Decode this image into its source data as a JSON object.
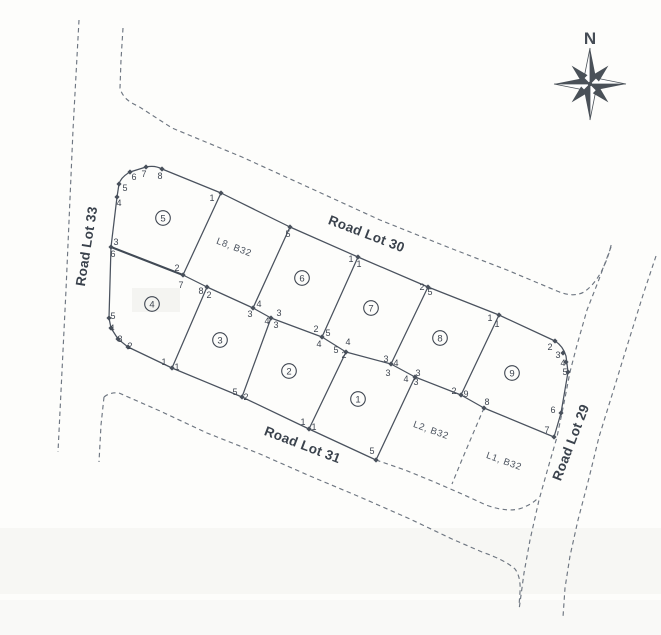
{
  "compass": {
    "label": "N"
  },
  "roads": [
    {
      "name": "Road Lot 30",
      "x": 365,
      "y": 238,
      "rotation": 21
    },
    {
      "name": "Road Lot 31",
      "x": 301,
      "y": 449,
      "rotation": 21
    },
    {
      "name": "Road Lot 33",
      "x": 91,
      "y": 247,
      "rotation": -81
    },
    {
      "name": "Road Lot 29",
      "x": 575,
      "y": 444,
      "rotation": -69
    }
  ],
  "lots": [
    {
      "num": "1",
      "x": 358,
      "y": 399
    },
    {
      "num": "2",
      "x": 289,
      "y": 371
    },
    {
      "num": "3",
      "x": 220,
      "y": 340
    },
    {
      "num": "4",
      "x": 152,
      "y": 304
    },
    {
      "num": "5",
      "x": 163,
      "y": 218
    },
    {
      "num": "6",
      "x": 302,
      "y": 278
    },
    {
      "num": "7",
      "x": 371,
      "y": 308
    },
    {
      "num": "8",
      "x": 440,
      "y": 338
    },
    {
      "num": "9",
      "x": 512,
      "y": 373
    }
  ],
  "parcels": [
    {
      "name": "L8, B32",
      "x": 233,
      "y": 250,
      "rotation": 21
    },
    {
      "name": "L2, B32",
      "x": 430,
      "y": 433,
      "rotation": 20
    },
    {
      "name": "L1, B32",
      "x": 503,
      "y": 464,
      "rotation": 20
    }
  ],
  "survey_points": [
    [
      117,
      197
    ],
    [
      119,
      184
    ],
    [
      130,
      172
    ],
    [
      146,
      167
    ],
    [
      162,
      169
    ],
    [
      221,
      193
    ],
    [
      290,
      227
    ],
    [
      358,
      257
    ],
    [
      428,
      287
    ],
    [
      499,
      315
    ],
    [
      555,
      341
    ],
    [
      563,
      353
    ],
    [
      566,
      362
    ],
    [
      568,
      372
    ],
    [
      561,
      413
    ],
    [
      554,
      437
    ],
    [
      484,
      408
    ],
    [
      461,
      395
    ],
    [
      415,
      377
    ],
    [
      391,
      364
    ],
    [
      346,
      352
    ],
    [
      322,
      337
    ],
    [
      271,
      318
    ],
    [
      253,
      308
    ],
    [
      207,
      287
    ],
    [
      183,
      275
    ],
    [
      111,
      247
    ],
    [
      109,
      318
    ],
    [
      111,
      328
    ],
    [
      118,
      339
    ],
    [
      128,
      347
    ],
    [
      172,
      368
    ],
    [
      242,
      397
    ],
    [
      309,
      429
    ],
    [
      376,
      460
    ]
  ],
  "vertex_labels": [
    {
      "t": "6",
      "x": 134,
      "y": 177
    },
    {
      "t": "7",
      "x": 144,
      "y": 174
    },
    {
      "t": "8",
      "x": 160,
      "y": 176
    },
    {
      "t": "5",
      "x": 125,
      "y": 188
    },
    {
      "t": "4",
      "x": 119,
      "y": 203
    },
    {
      "t": "3",
      "x": 116,
      "y": 242
    },
    {
      "t": "6",
      "x": 113,
      "y": 254
    },
    {
      "t": "1",
      "x": 212,
      "y": 198
    },
    {
      "t": "2",
      "x": 177,
      "y": 268
    },
    {
      "t": "7",
      "x": 181,
      "y": 285
    },
    {
      "t": "8",
      "x": 201,
      "y": 291
    },
    {
      "t": "2",
      "x": 209,
      "y": 295
    },
    {
      "t": "5",
      "x": 288,
      "y": 234
    },
    {
      "t": "4",
      "x": 259,
      "y": 304
    },
    {
      "t": "3",
      "x": 250,
      "y": 314
    },
    {
      "t": "3",
      "x": 279,
      "y": 313
    },
    {
      "t": "4",
      "x": 267,
      "y": 321
    },
    {
      "t": "3",
      "x": 276,
      "y": 325
    },
    {
      "t": "1",
      "x": 351,
      "y": 259
    },
    {
      "t": "1",
      "x": 359,
      "y": 264
    },
    {
      "t": "2",
      "x": 316,
      "y": 329
    },
    {
      "t": "5",
      "x": 328,
      "y": 333
    },
    {
      "t": "4",
      "x": 319,
      "y": 344
    },
    {
      "t": "4",
      "x": 348,
      "y": 342
    },
    {
      "t": "5",
      "x": 336,
      "y": 350
    },
    {
      "t": "2",
      "x": 344,
      "y": 355
    },
    {
      "t": "2",
      "x": 422,
      "y": 287
    },
    {
      "t": "5",
      "x": 430,
      "y": 292
    },
    {
      "t": "3",
      "x": 386,
      "y": 359
    },
    {
      "t": "4",
      "x": 396,
      "y": 363
    },
    {
      "t": "3",
      "x": 388,
      "y": 373
    },
    {
      "t": "1",
      "x": 490,
      "y": 318
    },
    {
      "t": "1",
      "x": 497,
      "y": 324
    },
    {
      "t": "3",
      "x": 418,
      "y": 373
    },
    {
      "t": "4",
      "x": 406,
      "y": 379
    },
    {
      "t": "3",
      "x": 416,
      "y": 382
    },
    {
      "t": "2",
      "x": 550,
      "y": 347
    },
    {
      "t": "3",
      "x": 558,
      "y": 355
    },
    {
      "t": "4",
      "x": 563,
      "y": 363
    },
    {
      "t": "5",
      "x": 565,
      "y": 372
    },
    {
      "t": "6",
      "x": 553,
      "y": 410
    },
    {
      "t": "7",
      "x": 547,
      "y": 430
    },
    {
      "t": "8",
      "x": 487,
      "y": 402
    },
    {
      "t": "2",
      "x": 454,
      "y": 391
    },
    {
      "t": "9",
      "x": 466,
      "y": 394
    },
    {
      "t": "5",
      "x": 113,
      "y": 316
    },
    {
      "t": "4",
      "x": 112,
      "y": 328
    },
    {
      "t": "3",
      "x": 120,
      "y": 339
    },
    {
      "t": "2",
      "x": 130,
      "y": 346
    },
    {
      "t": "1",
      "x": 164,
      "y": 362
    },
    {
      "t": "1",
      "x": 177,
      "y": 367
    },
    {
      "t": "5",
      "x": 235,
      "y": 392
    },
    {
      "t": "2",
      "x": 246,
      "y": 397
    },
    {
      "t": "1",
      "x": 303,
      "y": 422
    },
    {
      "t": "1",
      "x": 314,
      "y": 427
    },
    {
      "t": "5",
      "x": 372,
      "y": 451
    }
  ],
  "colors": {
    "solid_line": "#4a525e",
    "dashed_line": "#6e7681",
    "text": "#3e4550",
    "road_text": "#3a424c",
    "compass": "#4a5158",
    "paper": "#fdfdfb"
  }
}
